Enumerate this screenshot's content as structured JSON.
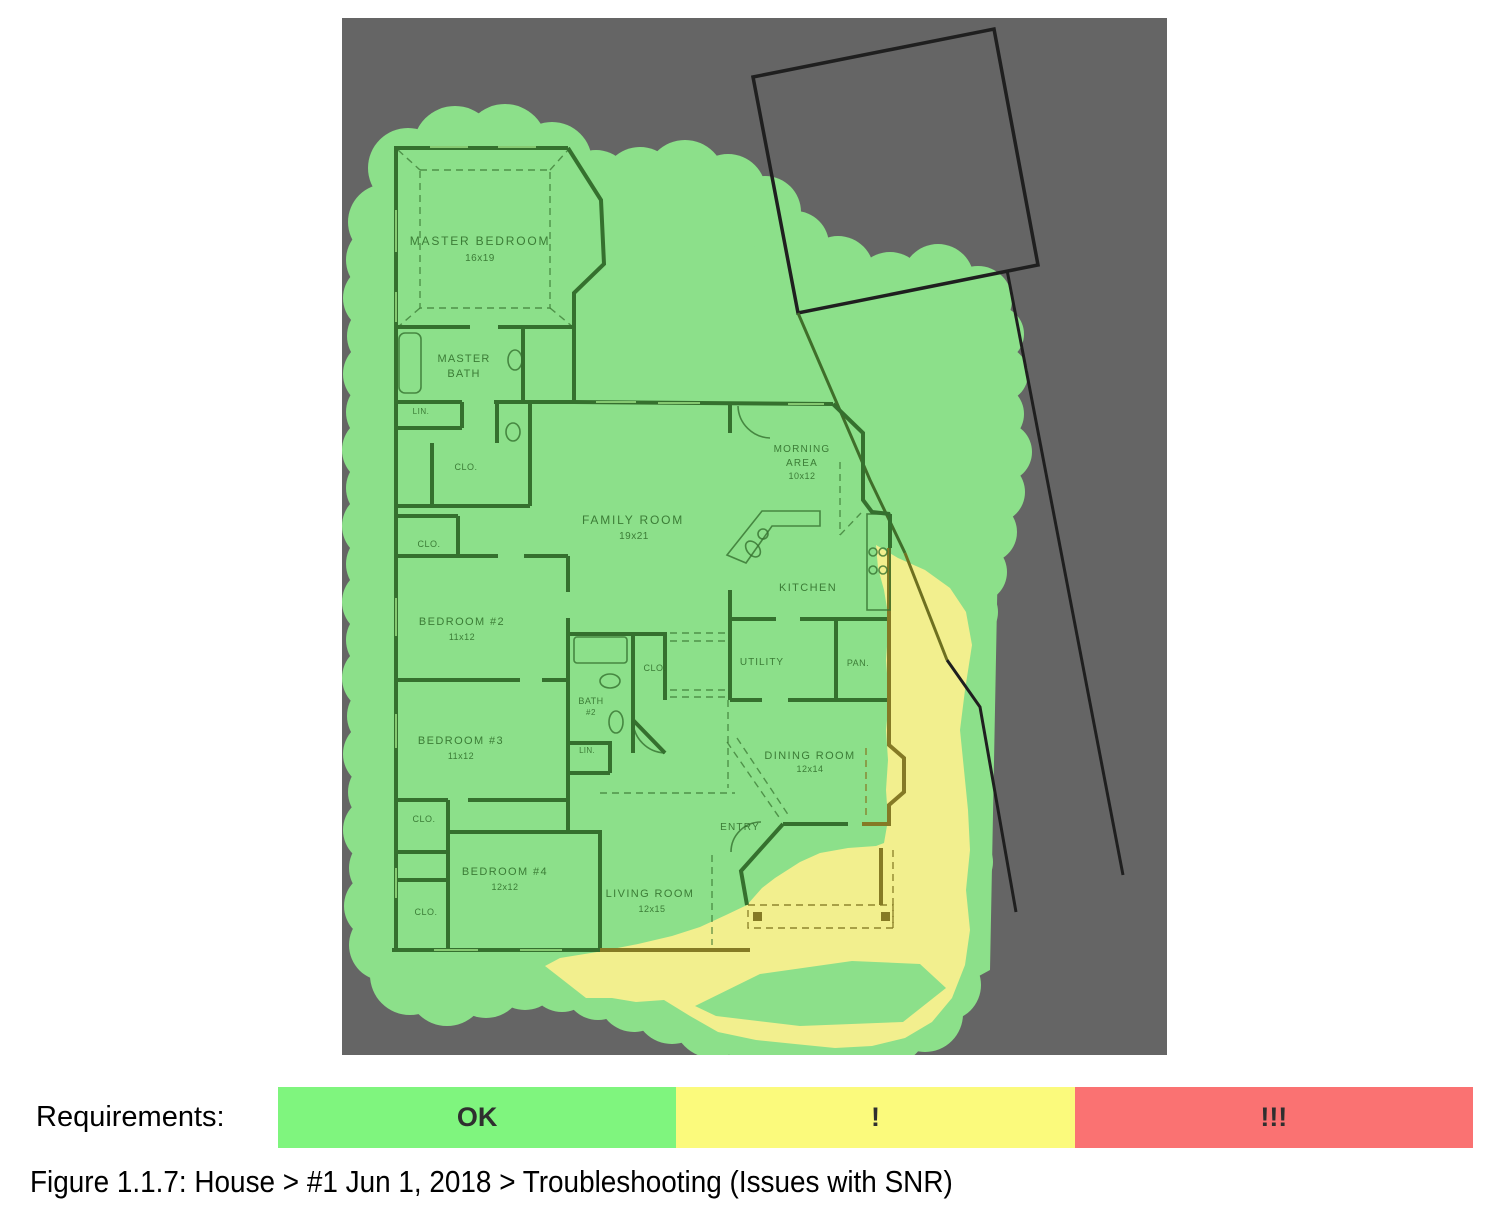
{
  "caption": "Figure 1.1.7: House > #1 Jun 1, 2018 > Troubleshooting (Issues with SNR)",
  "colors": {
    "canvas_bg": "#656565",
    "coverage_ok": "#8CE08A",
    "coverage_warning": "#F2EF8E",
    "plan_line": "#35702e",
    "plan_line_under_warning": "#857a25",
    "boundary_line": "#1f1f1f",
    "legend_ok": "#7FF57E",
    "legend_warning": "#FBFA7C",
    "legend_critical": "#FA7272"
  },
  "legend": {
    "label": "Requirements:",
    "segments": [
      {
        "key": "ok",
        "label": "OK",
        "color": "#7FF57E"
      },
      {
        "key": "warning",
        "label": "!",
        "color": "#FBFA7C"
      },
      {
        "key": "critical",
        "label": "!!!",
        "color": "#FA7272"
      }
    ]
  },
  "floorplan": {
    "labels": [
      {
        "text": "MASTER BEDROOM",
        "x": 480,
        "y": 245,
        "s": 12,
        "ls": 1.8
      },
      {
        "text": "16x19",
        "x": 480,
        "y": 261,
        "s": 10,
        "ls": 0.5
      },
      {
        "text": "MASTER",
        "x": 464,
        "y": 362,
        "s": 11,
        "ls": 1.2
      },
      {
        "text": "BATH",
        "x": 464,
        "y": 377,
        "s": 11,
        "ls": 1.2
      },
      {
        "text": "LIN.",
        "x": 421,
        "y": 414,
        "s": 8,
        "ls": 0.5
      },
      {
        "text": "CLO.",
        "x": 466,
        "y": 470,
        "s": 9,
        "ls": 0.5
      },
      {
        "text": "CLO.",
        "x": 429,
        "y": 547,
        "s": 9,
        "ls": 0.5
      },
      {
        "text": "MORNING",
        "x": 802,
        "y": 452,
        "s": 10,
        "ls": 1.2
      },
      {
        "text": "AREA",
        "x": 802,
        "y": 466,
        "s": 10,
        "ls": 1.2
      },
      {
        "text": "10x12",
        "x": 802,
        "y": 479,
        "s": 9,
        "ls": 0.5
      },
      {
        "text": "FAMILY ROOM",
        "x": 633,
        "y": 524,
        "s": 12,
        "ls": 1.8
      },
      {
        "text": "19x21",
        "x": 634,
        "y": 539,
        "s": 10,
        "ls": 0.5
      },
      {
        "text": "KITCHEN",
        "x": 808,
        "y": 591,
        "s": 11,
        "ls": 1.4
      },
      {
        "text": "BEDROOM #2",
        "x": 462,
        "y": 625,
        "s": 11,
        "ls": 1.4
      },
      {
        "text": "11x12",
        "x": 462,
        "y": 640,
        "s": 9,
        "ls": 0.5
      },
      {
        "text": "CLO.",
        "x": 655,
        "y": 671,
        "s": 9,
        "ls": 0.5
      },
      {
        "text": "UTILITY",
        "x": 762,
        "y": 665,
        "s": 10,
        "ls": 1.0
      },
      {
        "text": "PAN.",
        "x": 858,
        "y": 666,
        "s": 9,
        "ls": 0.5
      },
      {
        "text": "BATH",
        "x": 591,
        "y": 704,
        "s": 9,
        "ls": 0.5
      },
      {
        "text": "#2",
        "x": 591,
        "y": 715,
        "s": 8,
        "ls": 0.5
      },
      {
        "text": "BEDROOM #3",
        "x": 461,
        "y": 744,
        "s": 11,
        "ls": 1.4
      },
      {
        "text": "11x12",
        "x": 461,
        "y": 759,
        "s": 9,
        "ls": 0.5
      },
      {
        "text": "LIN.",
        "x": 587,
        "y": 753,
        "s": 8,
        "ls": 0.3
      },
      {
        "text": "DINING ROOM",
        "x": 810,
        "y": 759,
        "s": 11,
        "ls": 1.4
      },
      {
        "text": "12x14",
        "x": 810,
        "y": 772,
        "s": 9,
        "ls": 0.5
      },
      {
        "text": "CLO.",
        "x": 424,
        "y": 822,
        "s": 9,
        "ls": 0.5
      },
      {
        "text": "ENTRY",
        "x": 740,
        "y": 830,
        "s": 10,
        "ls": 1.2
      },
      {
        "text": "BEDROOM #4",
        "x": 505,
        "y": 875,
        "s": 11,
        "ls": 1.4
      },
      {
        "text": "12x12",
        "x": 505,
        "y": 890,
        "s": 9,
        "ls": 0.5
      },
      {
        "text": "CLO.",
        "x": 426,
        "y": 915,
        "s": 9,
        "ls": 0.5
      },
      {
        "text": "LIVING ROOM",
        "x": 650,
        "y": 897,
        "s": 11,
        "ls": 1.4
      },
      {
        "text": "12x15",
        "x": 652,
        "y": 912,
        "s": 9,
        "ls": 0.5
      }
    ]
  }
}
